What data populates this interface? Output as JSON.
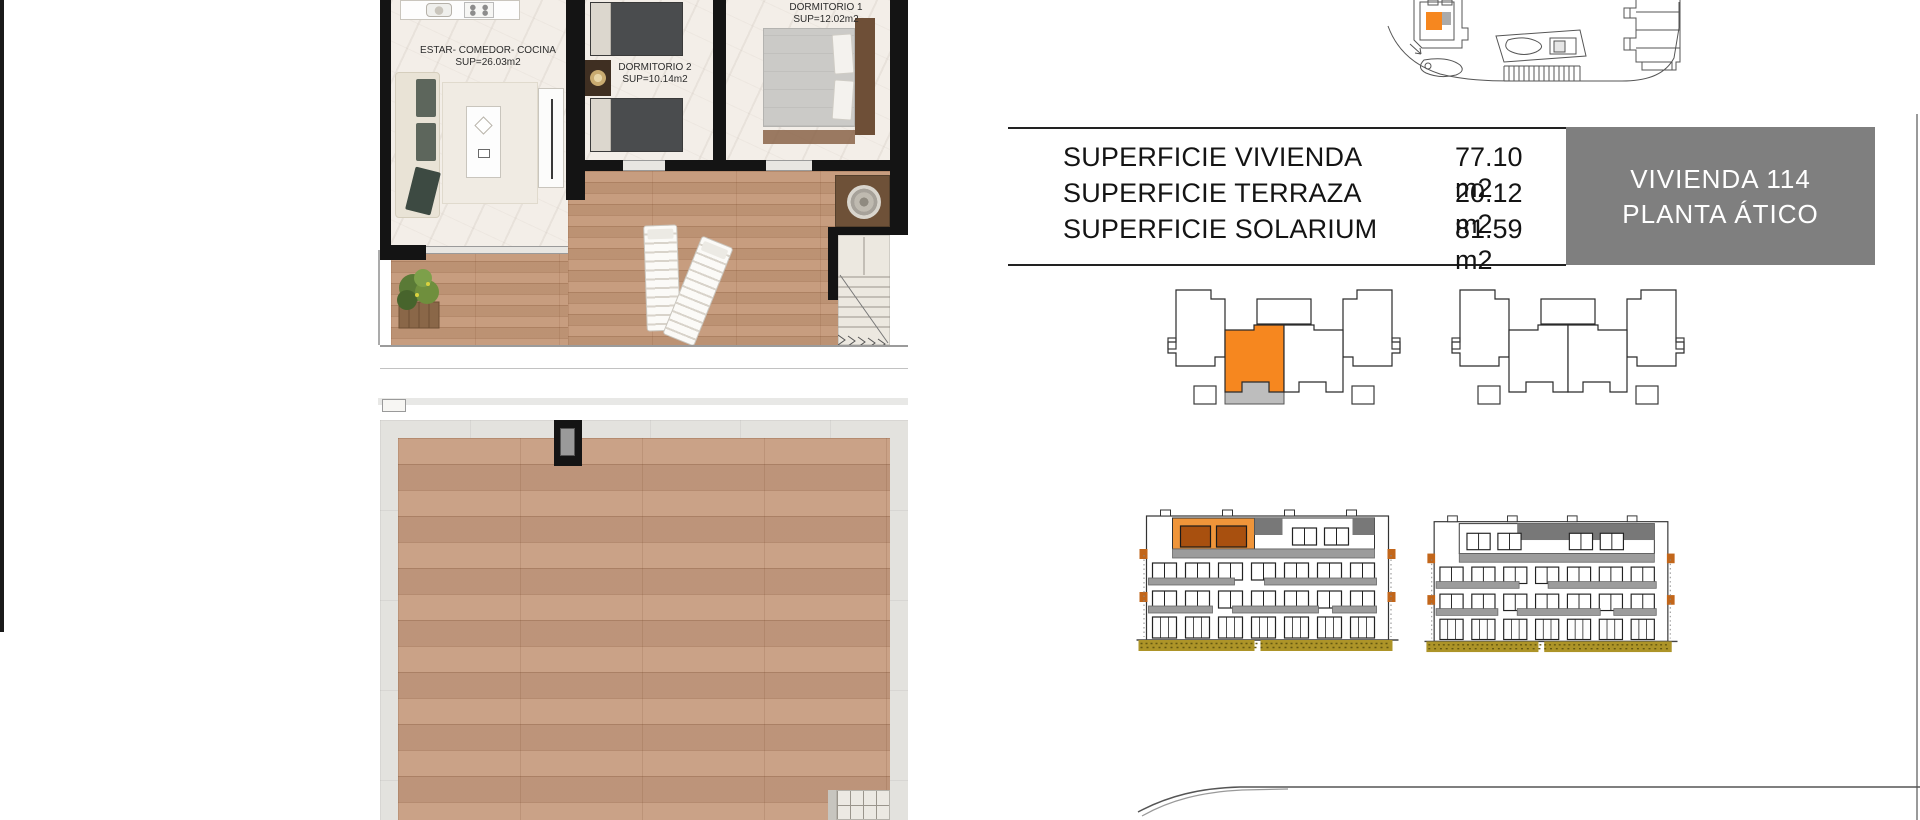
{
  "sheet": {
    "background": "#ffffff"
  },
  "colors": {
    "highlight_orange": "#f6871f",
    "elevation_orange": "#ef953a",
    "dark_window_orange": "#a8500f",
    "badge_gray": "#7f7f7f",
    "hedge_olive": "#ad9428",
    "railing_gray": "#9c9c9c"
  },
  "floorplan": {
    "living": {
      "line1": "ESTAR- COMEDOR- COCINA",
      "line2": "SUP=26.03m2"
    },
    "bedroom2": {
      "line1": "DORMITORIO 2",
      "line2": "SUP=10.14m2"
    },
    "bedroom1": {
      "line1": "DORMITORIO 1",
      "line2": "SUP=12.02m2"
    }
  },
  "summary": {
    "rows": [
      {
        "label": "SUPERFICIE VIVIENDA",
        "value": "77.10 m2"
      },
      {
        "label": "SUPERFICIE TERRAZA",
        "value": "20.12 m2"
      },
      {
        "label": "SUPERFICIE SOLARIUM",
        "value": "81.59 m2"
      }
    ]
  },
  "badge": {
    "line1": "VIVIENDA 114",
    "line2": "PLANTA ÁTICO"
  }
}
